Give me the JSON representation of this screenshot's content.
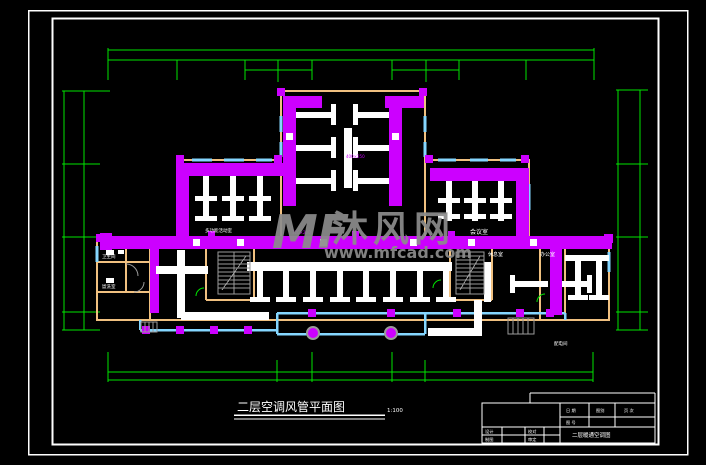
{
  "watermark": {
    "logo": "MF",
    "site_name": "沐风网",
    "site_url": "www.mfcad.com"
  },
  "drawing": {
    "title": "二层空调风管平面图",
    "scale": "1:100"
  },
  "rooms": {
    "multi_function": "多功能活动室",
    "meeting": "会议室",
    "office": "办公室",
    "lounge": "休息室",
    "toilet": "卫生间",
    "washroom": "盥洗室",
    "power_room": "配电间"
  },
  "ducts": {
    "size_a": "400×250",
    "size_b": "320×200"
  },
  "title_block": {
    "date_label": "日 期",
    "category_label": "图别",
    "page_label": "页 次",
    "number_label": "图 号",
    "design_label": "设计",
    "check_label": "校对",
    "draft_label": "制图",
    "approve_label": "审定",
    "drawing_name": "二层暖通空调图"
  },
  "colors": {
    "duct_magenta": "#cc00ff",
    "wall_tan": "#f0c080",
    "window_cyan": "#85d6ff",
    "dimension_green": "#00e400",
    "frame_white": "#ffffff",
    "stair_gray": "#9a9a9a",
    "watermark_gray": "#8c8c8c"
  }
}
